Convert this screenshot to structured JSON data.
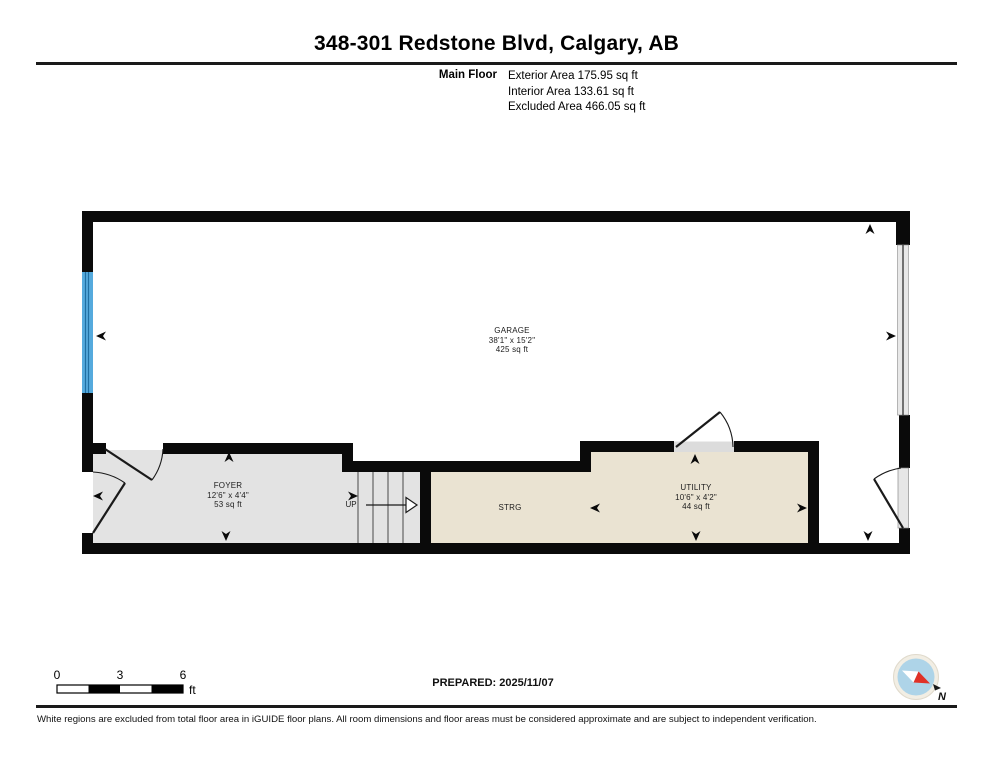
{
  "header": {
    "title": "348-301 Redstone Blvd, Calgary, AB"
  },
  "area_summary": {
    "floor_label": "Main Floor",
    "rows": [
      "Exterior Area 175.95 sq ft",
      "Interior Area 133.61 sq ft",
      "Excluded Area 466.05 sq ft"
    ]
  },
  "plan": {
    "rooms": {
      "garage": {
        "name": "GARAGE",
        "dims": "38'1\" x 15'2\"",
        "area": "425 sq ft"
      },
      "foyer": {
        "name": "FOYER",
        "dims": "12'6\" x 4'4\"",
        "area": "53 sq ft"
      },
      "storage": {
        "name": "STRG"
      },
      "utility": {
        "name": "UTILITY",
        "dims": "10'6\" x 4'2\"",
        "area": "44 sq ft"
      },
      "stairs": {
        "direction_label": "UP"
      }
    },
    "colors": {
      "wall_black": "#0a0a0a",
      "interior_gray": "#e3e3e3",
      "interior_beige": "#eae3d2",
      "window_blue": "#55aadd",
      "door_slab_gray": "#e6e6e6",
      "compass_blue": "#aed4e8",
      "compass_red": "#e03127"
    }
  },
  "scale_bar": {
    "ticks": [
      "0",
      "3",
      "6"
    ],
    "unit": "ft"
  },
  "prepared_label": "PREPARED: 2025/11/07",
  "compass": {
    "north_label": "N"
  },
  "footer": {
    "disclaimer": "White regions are excluded from total floor area in iGUIDE floor plans. All room dimensions and floor areas must be considered approximate and are subject to independent verification."
  }
}
